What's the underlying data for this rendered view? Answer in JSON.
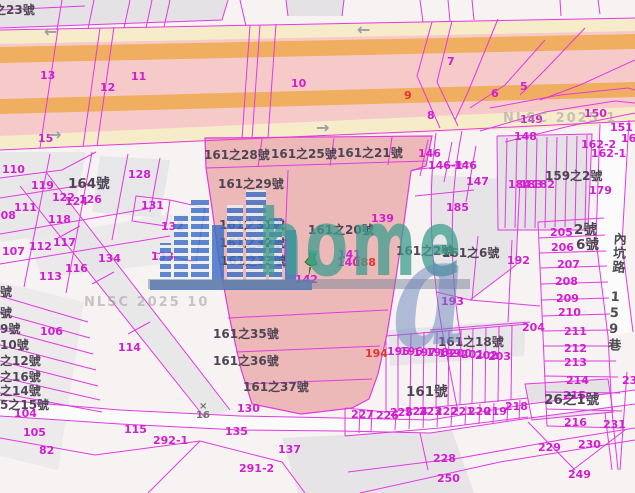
{
  "app": {
    "description": "cadastral land parcel map viewer"
  },
  "colors": {
    "boundary": "#e23ae2",
    "highlight_fill": "#e27272",
    "road_pink": "#f7caca",
    "road_orange": "#f0ae60",
    "road_yellow": "#f7ecca",
    "logo_teal": "#3e9e8e",
    "logo_blue": "#3c6fc4"
  },
  "watermark": {
    "logo_text": "home",
    "logo_a": "a",
    "nlsc": "NLSC 2025 10"
  },
  "street": {
    "name": "內坑路 159巷"
  },
  "labels": [
    {
      "t": "13",
      "x": 40,
      "y": 70,
      "c": "n"
    },
    {
      "t": "12",
      "x": 100,
      "y": 82,
      "c": "n"
    },
    {
      "t": "11",
      "x": 131,
      "y": 71,
      "c": "n"
    },
    {
      "t": "15",
      "x": 38,
      "y": 133,
      "c": "n"
    },
    {
      "t": "10",
      "x": 291,
      "y": 78,
      "c": "n"
    },
    {
      "t": "9",
      "x": 404,
      "y": 90,
      "c": "r"
    },
    {
      "t": "7",
      "x": 447,
      "y": 56,
      "c": "n"
    },
    {
      "t": "6",
      "x": 491,
      "y": 88,
      "c": "n"
    },
    {
      "t": "5",
      "x": 520,
      "y": 81,
      "c": "n"
    },
    {
      "t": "8",
      "x": 427,
      "y": 110,
      "c": "n"
    },
    {
      "t": "149",
      "x": 520,
      "y": 114,
      "c": "n"
    },
    {
      "t": "150",
      "x": 584,
      "y": 108,
      "c": "n"
    },
    {
      "t": "151",
      "x": 610,
      "y": 122,
      "c": "n"
    },
    {
      "t": "148",
      "x": 514,
      "y": 131,
      "c": "n"
    },
    {
      "t": "161",
      "x": 621,
      "y": 133,
      "c": "n"
    },
    {
      "t": "162-2",
      "x": 581,
      "y": 139,
      "c": "n"
    },
    {
      "t": "162-1",
      "x": 591,
      "y": 148,
      "c": "n"
    },
    {
      "t": "146",
      "x": 418,
      "y": 148,
      "c": "n"
    },
    {
      "t": "146-1",
      "x": 428,
      "y": 160,
      "c": "n"
    },
    {
      "t": "146",
      "x": 454,
      "y": 160,
      "c": "n"
    },
    {
      "t": "147",
      "x": 466,
      "y": 176,
      "c": "n"
    },
    {
      "t": "179",
      "x": 589,
      "y": 185,
      "c": "n"
    },
    {
      "t": "185",
      "x": 446,
      "y": 202,
      "c": "n"
    },
    {
      "t": "184",
      "x": 508,
      "y": 179,
      "c": "n"
    },
    {
      "t": "183",
      "x": 520,
      "y": 179,
      "c": "n"
    },
    {
      "t": "182",
      "x": 532,
      "y": 179,
      "c": "n"
    },
    {
      "t": "139",
      "x": 371,
      "y": 213,
      "c": "n"
    },
    {
      "t": "192",
      "x": 507,
      "y": 255,
      "c": "n"
    },
    {
      "t": "193",
      "x": 441,
      "y": 296,
      "c": "n"
    },
    {
      "t": "205",
      "x": 550,
      "y": 227,
      "c": "n"
    },
    {
      "t": "206",
      "x": 551,
      "y": 242,
      "c": "n"
    },
    {
      "t": "207",
      "x": 557,
      "y": 259,
      "c": "n"
    },
    {
      "t": "208",
      "x": 555,
      "y": 276,
      "c": "n"
    },
    {
      "t": "209",
      "x": 556,
      "y": 293,
      "c": "n"
    },
    {
      "t": "210",
      "x": 558,
      "y": 307,
      "c": "n"
    },
    {
      "t": "204",
      "x": 522,
      "y": 322,
      "c": "n"
    },
    {
      "t": "211",
      "x": 564,
      "y": 326,
      "c": "n"
    },
    {
      "t": "212",
      "x": 564,
      "y": 343,
      "c": "n"
    },
    {
      "t": "213",
      "x": 564,
      "y": 357,
      "c": "n"
    },
    {
      "t": "214",
      "x": 566,
      "y": 375,
      "c": "n"
    },
    {
      "t": "215",
      "x": 563,
      "y": 390,
      "c": "n"
    },
    {
      "t": "216",
      "x": 564,
      "y": 417,
      "c": "n"
    },
    {
      "t": "23",
      "x": 622,
      "y": 375,
      "c": "n"
    },
    {
      "t": "231",
      "x": 603,
      "y": 419,
      "c": "n"
    },
    {
      "t": "230",
      "x": 578,
      "y": 439,
      "c": "n"
    },
    {
      "t": "229",
      "x": 538,
      "y": 442,
      "c": "n"
    },
    {
      "t": "228",
      "x": 433,
      "y": 453,
      "c": "n"
    },
    {
      "t": "250",
      "x": 437,
      "y": 473,
      "c": "n"
    },
    {
      "t": "249",
      "x": 568,
      "y": 469,
      "c": "n"
    },
    {
      "t": "218",
      "x": 505,
      "y": 401,
      "c": "n"
    },
    {
      "t": "219",
      "x": 484,
      "y": 406,
      "c": "n"
    },
    {
      "t": "220",
      "x": 468,
      "y": 406,
      "c": "n"
    },
    {
      "t": "221",
      "x": 451,
      "y": 406,
      "c": "n"
    },
    {
      "t": "222",
      "x": 435,
      "y": 406,
      "c": "n"
    },
    {
      "t": "223",
      "x": 419,
      "y": 406,
      "c": "n"
    },
    {
      "t": "224",
      "x": 405,
      "y": 406,
      "c": "n"
    },
    {
      "t": "225",
      "x": 390,
      "y": 407,
      "c": "n"
    },
    {
      "t": "226",
      "x": 376,
      "y": 410,
      "c": "n"
    },
    {
      "t": "227",
      "x": 351,
      "y": 409,
      "c": "n"
    },
    {
      "t": "194",
      "x": 365,
      "y": 348,
      "c": "r"
    },
    {
      "t": "195",
      "x": 387,
      "y": 346,
      "c": "n"
    },
    {
      "t": "196",
      "x": 400,
      "y": 346,
      "c": "n"
    },
    {
      "t": "197",
      "x": 413,
      "y": 347,
      "c": "n"
    },
    {
      "t": "198",
      "x": 426,
      "y": 347,
      "c": "n"
    },
    {
      "t": "199",
      "x": 438,
      "y": 348,
      "c": "n"
    },
    {
      "t": "200",
      "x": 449,
      "y": 348,
      "c": "n"
    },
    {
      "t": "201",
      "x": 461,
      "y": 349,
      "c": "n"
    },
    {
      "t": "202",
      "x": 475,
      "y": 350,
      "c": "n"
    },
    {
      "t": "203",
      "x": 488,
      "y": 351,
      "c": "n"
    },
    {
      "t": "142",
      "x": 295,
      "y": 274,
      "c": "n"
    },
    {
      "t": "141",
      "x": 338,
      "y": 249,
      "c": "n"
    },
    {
      "t": "140",
      "x": 337,
      "y": 257,
      "c": "n"
    },
    {
      "t": "188",
      "x": 353,
      "y": 257,
      "c": "r"
    },
    {
      "t": "110",
      "x": 2,
      "y": 164,
      "c": "n"
    },
    {
      "t": "119",
      "x": 31,
      "y": 180,
      "c": "n"
    },
    {
      "t": "111",
      "x": 14,
      "y": 202,
      "c": "n"
    },
    {
      "t": "108",
      "x": -7,
      "y": 210,
      "c": "n"
    },
    {
      "t": "122",
      "x": 52,
      "y": 192,
      "c": "n"
    },
    {
      "t": "124",
      "x": 65,
      "y": 196,
      "c": "n"
    },
    {
      "t": "126",
      "x": 79,
      "y": 194,
      "c": "n"
    },
    {
      "t": "128",
      "x": 128,
      "y": 169,
      "c": "n"
    },
    {
      "t": "131",
      "x": 141,
      "y": 200,
      "c": "n"
    },
    {
      "t": "132",
      "x": 161,
      "y": 221,
      "c": "n"
    },
    {
      "t": "118",
      "x": 48,
      "y": 214,
      "c": "n"
    },
    {
      "t": "117",
      "x": 53,
      "y": 237,
      "c": "n"
    },
    {
      "t": "112",
      "x": 29,
      "y": 241,
      "c": "n"
    },
    {
      "t": "107",
      "x": 2,
      "y": 246,
      "c": "n"
    },
    {
      "t": "134",
      "x": 98,
      "y": 253,
      "c": "n"
    },
    {
      "t": "133",
      "x": 151,
      "y": 251,
      "c": "n"
    },
    {
      "t": "116",
      "x": 65,
      "y": 263,
      "c": "n"
    },
    {
      "t": "113",
      "x": 39,
      "y": 271,
      "c": "n"
    },
    {
      "t": "106",
      "x": 40,
      "y": 326,
      "c": "n"
    },
    {
      "t": "114",
      "x": 118,
      "y": 342,
      "c": "n"
    },
    {
      "t": "115",
      "x": 124,
      "y": 424,
      "c": "n"
    },
    {
      "t": "104",
      "x": 14,
      "y": 408,
      "c": "n"
    },
    {
      "t": "105",
      "x": 23,
      "y": 427,
      "c": "n"
    },
    {
      "t": "82",
      "x": 39,
      "y": 445,
      "c": "n"
    },
    {
      "t": "130",
      "x": 237,
      "y": 403,
      "c": "n"
    },
    {
      "t": "135",
      "x": 225,
      "y": 426,
      "c": "n"
    },
    {
      "t": "137",
      "x": 278,
      "y": 444,
      "c": "n"
    },
    {
      "t": "291-2",
      "x": 239,
      "y": 463,
      "c": "n"
    },
    {
      "t": "292-1",
      "x": 153,
      "y": 435,
      "c": "n"
    },
    {
      "t": "之23號",
      "x": -6,
      "y": 4,
      "c": "a"
    },
    {
      "t": "164號",
      "x": 68,
      "y": 178,
      "c": "a lg"
    },
    {
      "t": "161之28號",
      "x": 204,
      "y": 149,
      "c": "a"
    },
    {
      "t": "161之25號",
      "x": 271,
      "y": 148,
      "c": "a"
    },
    {
      "t": "161之21號",
      "x": 337,
      "y": 147,
      "c": "a"
    },
    {
      "t": "161之29號",
      "x": 218,
      "y": 178,
      "c": "a"
    },
    {
      "t": "161之31號",
      "x": 219,
      "y": 219,
      "c": "a"
    },
    {
      "t": "161之32號",
      "x": 219,
      "y": 237,
      "c": "a"
    },
    {
      "t": "161之33號",
      "x": 220,
      "y": 255,
      "c": "a"
    },
    {
      "t": "161之20號",
      "x": 308,
      "y": 224,
      "c": "a"
    },
    {
      "t": "161之35號",
      "x": 213,
      "y": 328,
      "c": "a"
    },
    {
      "t": "161之36號",
      "x": 213,
      "y": 355,
      "c": "a"
    },
    {
      "t": "161之37號",
      "x": 243,
      "y": 381,
      "c": "a"
    },
    {
      "t": "161之2號",
      "x": 396,
      "y": 245,
      "c": "a"
    },
    {
      "t": "161之6號",
      "x": 442,
      "y": 247,
      "c": "a"
    },
    {
      "t": "159之2號",
      "x": 545,
      "y": 170,
      "c": "a"
    },
    {
      "t": "2號",
      "x": 574,
      "y": 224,
      "c": "a lg"
    },
    {
      "t": "6號",
      "x": 576,
      "y": 239,
      "c": "a lg"
    },
    {
      "t": "161之18號",
      "x": 438,
      "y": 336,
      "c": "a"
    },
    {
      "t": "161號",
      "x": 406,
      "y": 386,
      "c": "a lg"
    },
    {
      "t": "26之1號",
      "x": 544,
      "y": 394,
      "c": "a lg"
    },
    {
      "t": "號",
      "x": 0,
      "y": 286,
      "c": "a"
    },
    {
      "t": "號",
      "x": 0,
      "y": 307,
      "c": "a"
    },
    {
      "t": "9號",
      "x": 0,
      "y": 323,
      "c": "a"
    },
    {
      "t": "10號",
      "x": 0,
      "y": 339,
      "c": "a"
    },
    {
      "t": "之12號",
      "x": 0,
      "y": 355,
      "c": "a"
    },
    {
      "t": "之16號",
      "x": 0,
      "y": 371,
      "c": "a"
    },
    {
      "t": "之14號",
      "x": 0,
      "y": 385,
      "c": "a"
    },
    {
      "t": "5之15號",
      "x": 0,
      "y": 399,
      "c": "a"
    },
    {
      "t": "NLSC 2025 1",
      "x": 503,
      "y": 112,
      "c": "w"
    },
    {
      "t": "NLSC 2025 10",
      "x": 84,
      "y": 296,
      "c": "w"
    },
    {
      "t": "×",
      "x": 199,
      "y": 402,
      "c": "m"
    },
    {
      "t": "16",
      "x": 196,
      "y": 411,
      "c": "m"
    },
    {
      "t": "←",
      "x": 44,
      "y": 24,
      "c": "ar"
    },
    {
      "t": "←",
      "x": 357,
      "y": 22,
      "c": "ar"
    },
    {
      "t": "→",
      "x": 316,
      "y": 120,
      "c": "ar"
    },
    {
      "t": "→",
      "x": 48,
      "y": 127,
      "c": "ar"
    }
  ]
}
